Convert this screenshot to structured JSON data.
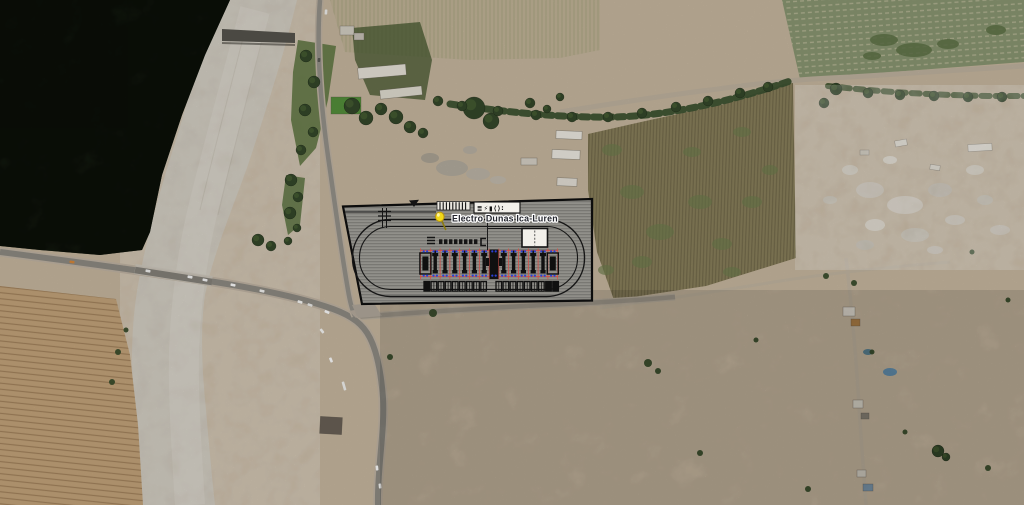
{
  "app": {
    "title": "Satellite imagery with substation site-plan overlay"
  },
  "placemark": {
    "label": "Electro Dunas Ica-Luren",
    "pin_color": "#f2d918",
    "pin_stroke": "#b9960f",
    "text_color": "#23252d",
    "halo_color": "#ffffff"
  },
  "site_plan": {
    "colors": {
      "outline": "#0c0c0c",
      "fill": "#8f8e8a",
      "grid": "#e04840",
      "dot": "#2b3fd4",
      "unit": "#101010",
      "building_fill": "#f2f0ea",
      "legend_box_fill": "#f2f0ea",
      "comb_fill": "#eae7e0"
    },
    "legend_glyphs": "≣⚡▮⟨⟩∶",
    "comb": {
      "x0": 440,
      "step": 3.2,
      "count": 9,
      "y1": 202.2,
      "y2": 209.8
    },
    "busbar": {
      "x0": 439,
      "step": 5,
      "count": 8,
      "y": 239.3,
      "w": 3.4,
      "h": 4.8
    },
    "bays": {
      "x0": 420.5,
      "step": 9.8,
      "columns": 15,
      "y_grid_top": 248.5,
      "y_grid_bottom": 279.5,
      "rail_y1": 250.6,
      "rail_y2": 276.4,
      "slots": [
        "big",
        "bay",
        "bay",
        "bay",
        "bay",
        "bay",
        "bay",
        "center",
        "bay",
        "bay",
        "bay",
        "bay",
        "bay",
        "big"
      ]
    },
    "foundations": {
      "y": 281.5,
      "w": 5.6,
      "h": 9.6,
      "step": 7.1,
      "left_x0": 424,
      "right_x0": 496,
      "left": [
        "filled",
        "open",
        "open",
        "open",
        "open",
        "open",
        "open",
        "open",
        "open"
      ],
      "right": [
        "open",
        "open",
        "open",
        "open",
        "open",
        "open",
        "open",
        "filled",
        "filled"
      ]
    }
  },
  "map": {
    "colors": {
      "sand": "#c9b9a1",
      "forest": "#2b3b22",
      "river": "#cbc4b6",
      "road_core": "#8f8c84",
      "road_shoulder": "#c2b6a5",
      "dirt_road": "#c1b5a1",
      "field_plowed": "#c6a67c",
      "field_green": "#8b9873",
      "field_olive": "#8a805c",
      "tree": "#34482a",
      "bush": "#3a4e2c"
    },
    "cars": [
      [
        72,
        262,
        8,
        "#d8893a",
        5
      ],
      [
        148,
        271,
        9,
        "#f4f4f2",
        5
      ],
      [
        190,
        277,
        10,
        "#fafafa",
        5
      ],
      [
        205,
        280,
        11,
        "#fafafa",
        5
      ],
      [
        233,
        285,
        12,
        "#ffffff",
        5
      ],
      [
        262,
        291,
        13,
        "#f6f6f4",
        5
      ],
      [
        300,
        302,
        17,
        "#fcfcfa",
        5
      ],
      [
        310,
        305,
        18,
        "#eeeeec",
        5
      ],
      [
        327,
        312,
        24,
        "#ffffff",
        5
      ],
      [
        322,
        331,
        52,
        "#f8f8f6",
        5
      ],
      [
        331,
        360,
        68,
        "#ffffff",
        5
      ],
      [
        344,
        386,
        74,
        "#f4f4f2",
        9
      ],
      [
        377,
        468,
        84,
        "#ffffff",
        5
      ],
      [
        380,
        486,
        84,
        "#f8f8f6",
        5
      ],
      [
        326,
        12,
        94,
        "#f2f2f0",
        5
      ],
      [
        319,
        60,
        95,
        "#5a5a55",
        4
      ]
    ],
    "trees": [
      [
        306,
        56,
        6
      ],
      [
        314,
        82,
        6
      ],
      [
        305,
        110,
        6
      ],
      [
        313,
        132,
        5
      ],
      [
        301,
        150,
        5
      ],
      [
        291,
        180,
        6
      ],
      [
        298,
        197,
        5
      ],
      [
        290,
        213,
        6
      ],
      [
        297,
        228,
        4
      ],
      [
        288,
        241,
        4
      ],
      [
        258,
        240,
        6
      ],
      [
        271,
        246,
        5
      ],
      [
        352,
        106,
        8
      ],
      [
        366,
        118,
        7
      ],
      [
        381,
        109,
        6
      ],
      [
        396,
        117,
        7
      ],
      [
        410,
        127,
        6
      ],
      [
        423,
        133,
        5
      ],
      [
        438,
        101,
        5
      ],
      [
        474,
        108,
        11
      ],
      [
        491,
        121,
        8
      ],
      [
        530,
        103,
        5
      ],
      [
        547,
        109,
        4
      ],
      [
        560,
        97,
        4
      ],
      [
        462,
        106,
        5
      ],
      [
        498,
        111,
        5
      ],
      [
        536,
        115,
        5
      ],
      [
        572,
        117,
        5
      ],
      [
        608,
        117,
        5
      ],
      [
        642,
        113,
        5
      ],
      [
        676,
        107,
        5
      ],
      [
        708,
        101,
        5
      ],
      [
        740,
        93,
        5
      ],
      [
        768,
        87,
        5
      ],
      [
        836,
        89,
        6
      ],
      [
        868,
        93,
        5
      ],
      [
        900,
        95,
        5
      ],
      [
        934,
        96,
        5
      ],
      [
        968,
        97,
        5
      ],
      [
        1002,
        97,
        5
      ],
      [
        824,
        103,
        5
      ],
      [
        938,
        451,
        6
      ],
      [
        946,
        457,
        4
      ]
    ],
    "bushes": [
      [
        433,
        313,
        4
      ],
      [
        390,
        357,
        3
      ],
      [
        648,
        363,
        4
      ],
      [
        658,
        371,
        3
      ],
      [
        700,
        453,
        3
      ],
      [
        808,
        489,
        3
      ],
      [
        826,
        276,
        3
      ],
      [
        854,
        283,
        3
      ],
      [
        872,
        352,
        2.5
      ],
      [
        756,
        340,
        2.5
      ],
      [
        905,
        432,
        2.5
      ],
      [
        988,
        468,
        3
      ],
      [
        1008,
        300,
        2.5
      ],
      [
        972,
        252,
        2.5
      ],
      [
        118,
        352,
        3
      ],
      [
        112,
        382,
        3
      ],
      [
        126,
        330,
        2.5
      ]
    ],
    "crop_patches": [
      [
        612,
        150,
        10,
        6
      ],
      [
        632,
        192,
        12,
        7
      ],
      [
        660,
        232,
        14,
        8
      ],
      [
        642,
        262,
        10,
        6
      ],
      [
        700,
        202,
        12,
        7
      ],
      [
        722,
        244,
        10,
        6
      ],
      [
        692,
        152,
        9,
        5
      ],
      [
        742,
        132,
        9,
        5
      ],
      [
        752,
        202,
        10,
        6
      ],
      [
        732,
        272,
        9,
        5
      ],
      [
        606,
        270,
        8,
        5
      ],
      [
        770,
        170,
        8,
        5
      ]
    ],
    "greenfield_patches": [
      [
        884,
        40,
        14,
        6
      ],
      [
        914,
        50,
        18,
        7
      ],
      [
        948,
        44,
        11,
        5
      ],
      [
        872,
        56,
        9,
        4
      ],
      [
        996,
        30,
        10,
        5
      ]
    ],
    "buildings": [
      [
        358,
        66,
        48,
        11,
        -5,
        "#e9e5da"
      ],
      [
        380,
        88,
        42,
        9,
        -6,
        "#e4e0d4"
      ],
      [
        556,
        131,
        26,
        8,
        2,
        "#efece4"
      ],
      [
        552,
        150,
        28,
        9,
        2,
        "#efece4"
      ],
      [
        557,
        178,
        20,
        8,
        2,
        "#e6e2d8"
      ],
      [
        521,
        158,
        16,
        7,
        0,
        "#d8d3c8"
      ],
      [
        340,
        26,
        14,
        9,
        0,
        "#d6d1c6"
      ],
      [
        354,
        33,
        10,
        7,
        0,
        "#c9c4b9"
      ],
      [
        320,
        417,
        22,
        17,
        3,
        "#6b6157"
      ],
      [
        843,
        307,
        12,
        9,
        0,
        "#e2ddd2"
      ],
      [
        851,
        319,
        9,
        7,
        0,
        "#b08148"
      ],
      [
        853,
        400,
        10,
        8,
        0,
        "#ded9cd"
      ],
      [
        861,
        413,
        8,
        6,
        0,
        "#8a8378"
      ],
      [
        857,
        470,
        9,
        7,
        0,
        "#d8d3c7"
      ],
      [
        863,
        484,
        10,
        7,
        0,
        "#7d98ad"
      ],
      [
        895,
        140,
        12,
        6,
        -10,
        "#e5e0d5"
      ],
      [
        930,
        165,
        10,
        5,
        8,
        "#ddd8cc"
      ],
      [
        860,
        150,
        9,
        5,
        0,
        "#ccc6b8"
      ],
      [
        968,
        144,
        24,
        7,
        -3,
        "#e8e4da"
      ],
      [
        331,
        97,
        30,
        17,
        0,
        "#55913b"
      ]
    ],
    "debris": [
      [
        870,
        190,
        14,
        8,
        "#cfc9bb"
      ],
      [
        905,
        205,
        18,
        9,
        "#d8d2c5"
      ],
      [
        940,
        190,
        12,
        7,
        "#c5bfb1"
      ],
      [
        875,
        225,
        10,
        6,
        "#ddd7ca"
      ],
      [
        915,
        235,
        14,
        7,
        "#cbc5b7"
      ],
      [
        955,
        220,
        10,
        5,
        "#d2ccbf"
      ],
      [
        985,
        200,
        8,
        5,
        "#c8c2b4"
      ],
      [
        850,
        170,
        8,
        5,
        "#d5cfc2"
      ],
      [
        890,
        160,
        7,
        4,
        "#e0dbcf"
      ],
      [
        865,
        245,
        9,
        5,
        "#c2bcae"
      ],
      [
        935,
        250,
        8,
        4,
        "#d0cabd"
      ],
      [
        830,
        200,
        7,
        4,
        "#cac4b6"
      ],
      [
        975,
        170,
        9,
        5,
        "#d7d1c4"
      ],
      [
        1000,
        230,
        10,
        5,
        "#cfc9bb"
      ],
      [
        890,
        372,
        7,
        4,
        "#5b8fb5"
      ],
      [
        868,
        352,
        5,
        3,
        "#4f7d92"
      ],
      [
        452,
        168,
        16,
        8,
        "#b3aca0"
      ],
      [
        478,
        174,
        12,
        6,
        "#beb7aa"
      ],
      [
        430,
        158,
        9,
        5,
        "#aaa396"
      ],
      [
        498,
        180,
        8,
        4,
        "#c4bdb0"
      ],
      [
        470,
        150,
        7,
        4,
        "#b8b1a4"
      ]
    ]
  }
}
